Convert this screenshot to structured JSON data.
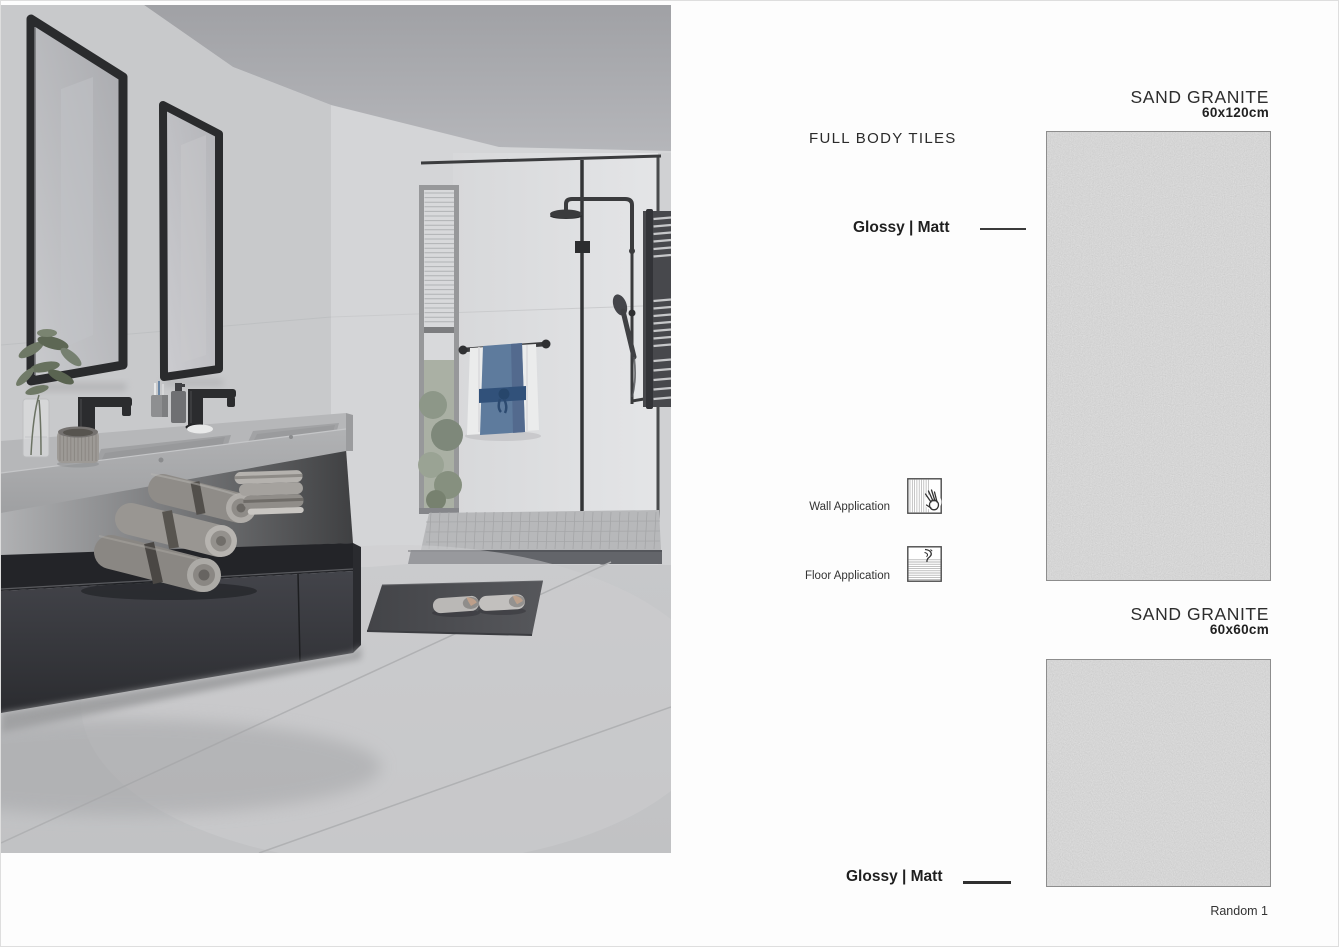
{
  "header": {
    "collection": "FULL BODY TILES"
  },
  "products": [
    {
      "name": "SAND GRANITE",
      "size": "60x120cm",
      "finish": "Glossy | Matt"
    },
    {
      "name": "SAND GRANITE",
      "size": "60x60cm",
      "finish": "Glossy | Matt",
      "variant": "Random 1"
    }
  ],
  "applications": [
    {
      "label": "Wall Application",
      "icon": "wall-application-icon"
    },
    {
      "label": "Floor Application",
      "icon": "floor-application-icon"
    }
  ],
  "colors": {
    "granite_base": "#a9a9a9",
    "text_primary": "#2b2b2b",
    "rule_dark": "#3a3a3a",
    "page_background": "#fdfdfd",
    "photo_wall_grey": "#c8c9cb",
    "cabinet_charcoal": "#333438",
    "towel_blue": "#5e7b9d"
  }
}
